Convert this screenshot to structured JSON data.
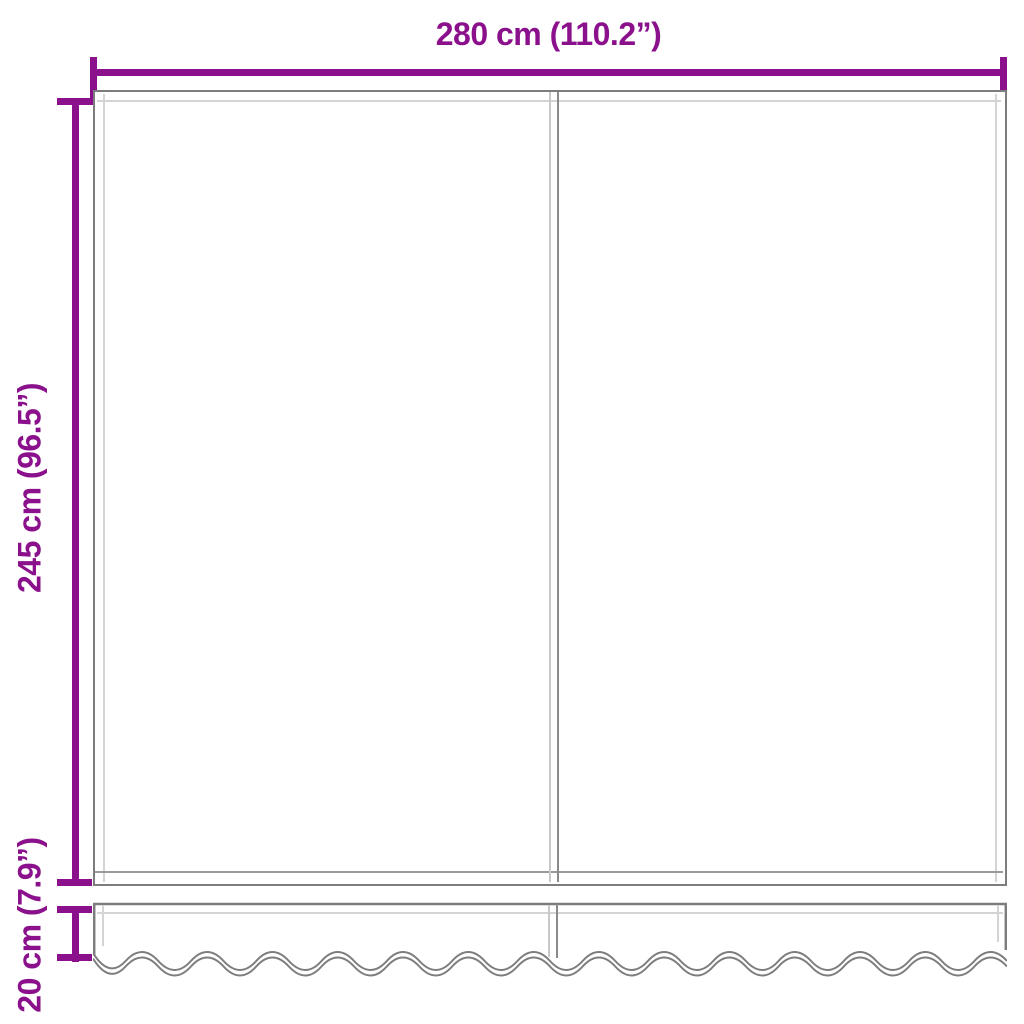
{
  "diagram": {
    "type": "product-dimension-diagram",
    "subject": "awning replacement fabric panel with wavy valance strip",
    "accent_color": "#8B108C",
    "outline_color": "#7d7d7d",
    "inner_stitch_color": "#d4d4d4",
    "background_color": "#ffffff",
    "dimensions": {
      "width": {
        "label": "280 cm (110.2”)",
        "cm": 280,
        "inches": 110.2
      },
      "height": {
        "label": "245 cm (96.5”)",
        "cm": 245,
        "inches": 96.5
      },
      "valance_height": {
        "label": "20 cm (7.9”)",
        "cm": 20,
        "inches": 7.9
      }
    }
  }
}
